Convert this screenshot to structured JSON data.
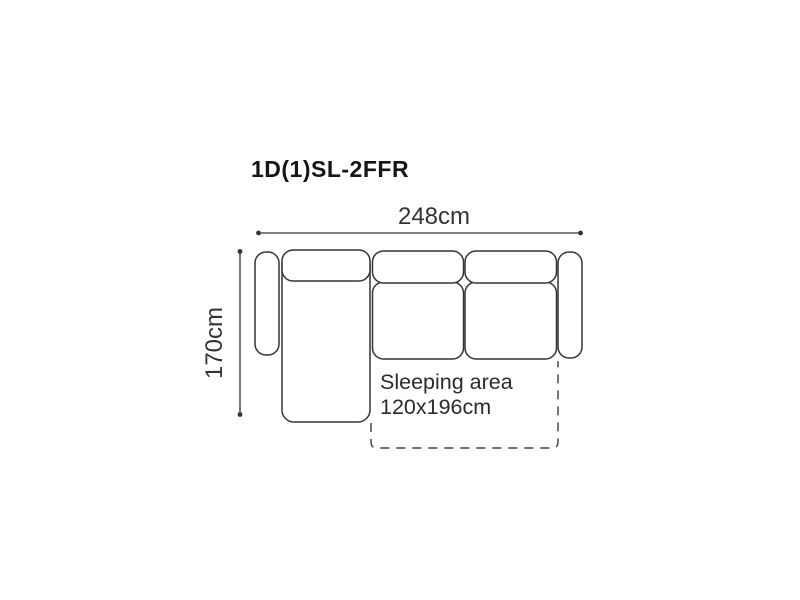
{
  "diagram": {
    "title": "1D(1)SL-2FFR",
    "dimensions": {
      "width_label": "248cm",
      "depth_label": "170cm"
    },
    "sleeping_area": {
      "label_line1": "Sleeping area",
      "label_line2": "120x196cm"
    },
    "colors": {
      "background": "#ffffff",
      "outline": "#343434",
      "title_text": "#151515",
      "dimension_text": "#333333"
    }
  }
}
